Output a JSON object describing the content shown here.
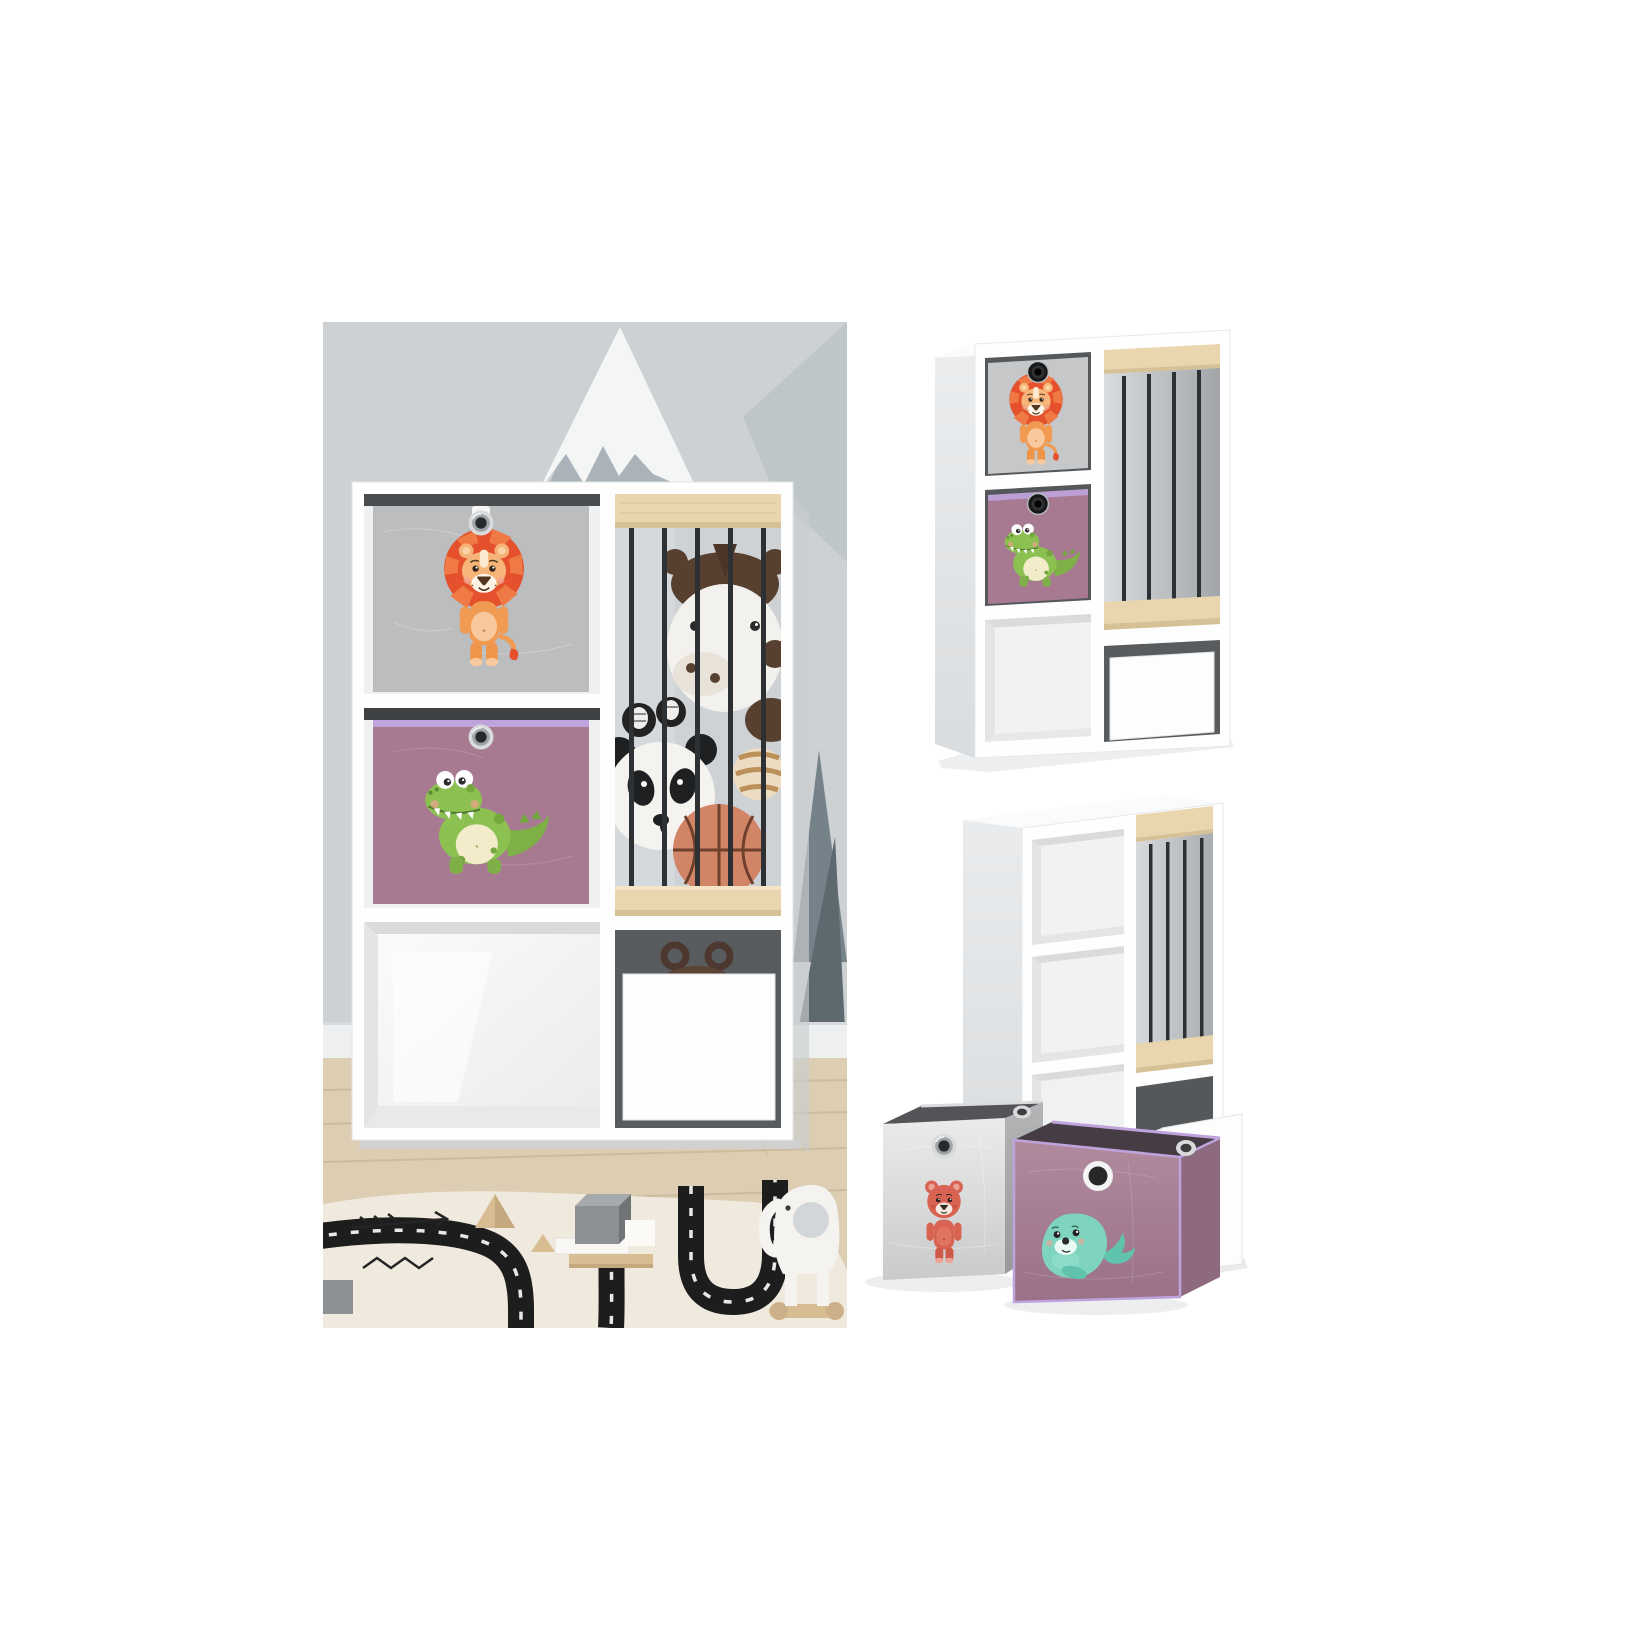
{
  "collage": {
    "photos": [
      {
        "id": "lifestyle",
        "alt": "Kids room scene: white six-compartment shelf in front of a grey mountain mural wall; grey fabric box with lion, purple fabric box with crocodile, slatted compartment with black rods holding plush horse, pandas, striped ball and basketball, white drawer with hippo plush peeking out; wood floor, cream rug with black road print, wooden blocks and a white elephant pull toy"
      },
      {
        "id": "angled-product-shot",
        "alt": "Angled product view of the white shelf with grey lion box, purple crocodile box, slatted toy compartment with wooden rails and black rods, open cube and closed white drawer"
      },
      {
        "id": "empty-product-shot",
        "alt": "Empty white shelf with the drawer pulled out and two foldable fabric boxes in front: grey box with red bear, purple box with teal seal"
      }
    ]
  },
  "palette": {
    "white": "#ffffff",
    "wall": "#cdd1d4",
    "snow": "#f4f6f6",
    "rock": "#a9b3b9",
    "slope": "#bfc6ca",
    "tree": "#76828a",
    "treeDark": "#5d686f",
    "baseboard": "#edeff0",
    "floor": "#dccdb3",
    "plank": "#c8b79b",
    "shelf": "#fefefe",
    "interior": "#eef0f1",
    "interiorDark": "#55585b",
    "wood": "#e9d6ae",
    "woodEdge": "#d6c095",
    "bar": "#2e3134",
    "greyBox": "#bcbdbf",
    "greyBoxLight": "#c6c7c9",
    "purpleBox": "#a77a92",
    "lilac": "#bfa3dd",
    "lionMane": "#e4512c",
    "lionSkin": "#f7b478",
    "crocGreen": "#8cc152",
    "crocBelly": "#f2eccb",
    "plush": "#f2f1ee",
    "horseBrown": "#57402f",
    "pandaBlack": "#1f2022",
    "basketball": "#d28566",
    "stripedBall": "#ecdcc2",
    "hippoBrown": "#5a4335",
    "rug": "#f0eade",
    "road": "#1d1d1d",
    "blockGrey": "#8d9093",
    "woodBlock": "#d8bd93",
    "bearRed": "#d96352",
    "sealTeal": "#7fd4c0",
    "sealBoxFront": "#a77e93",
    "sealBoxSide": "#8d6a7e",
    "drawer": "#fdfdfd",
    "grommetSilver": "#d8dadc",
    "grommetHole": "#26282a"
  },
  "illustrations": {
    "box_animals": [
      "lion",
      "crocodile",
      "bear",
      "seal"
    ],
    "toys": [
      "panda plush",
      "horse plush",
      "basketball",
      "striped ball",
      "hippo plush",
      "elephant pull toy",
      "wooden blocks",
      "road play rug"
    ]
  }
}
